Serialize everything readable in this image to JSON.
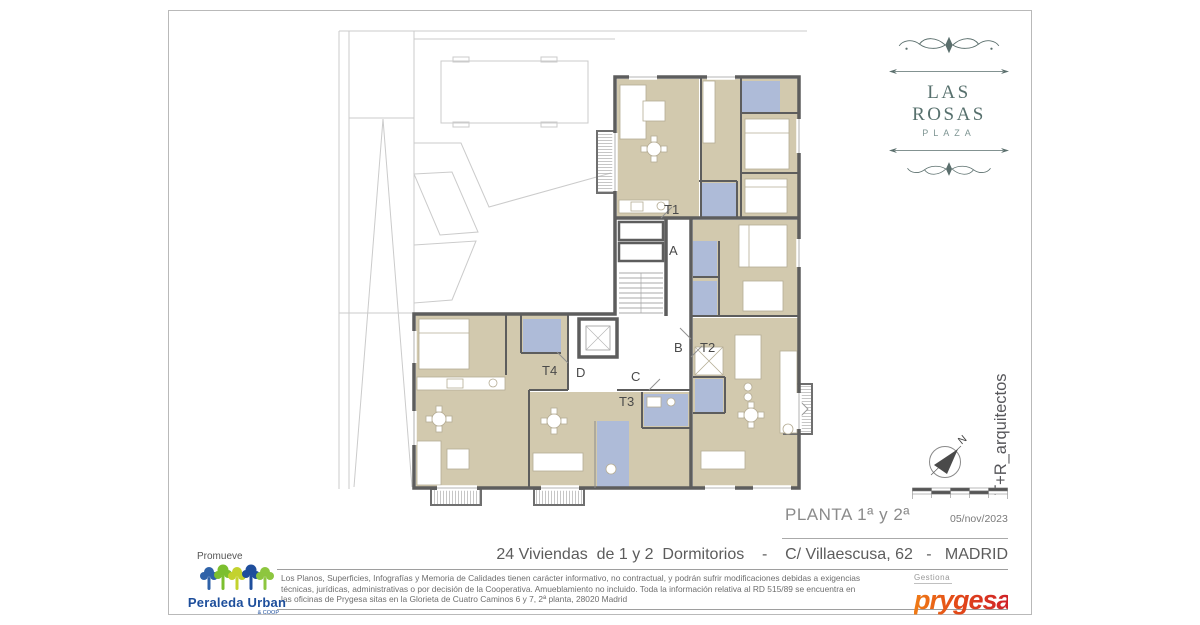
{
  "brand": {
    "name": "LAS ROSAS",
    "tagline": "PLAZA"
  },
  "architect_signature": "T+R_arquitectos",
  "compass": {
    "north_label": "N"
  },
  "plan": {
    "labels": [
      {
        "text": "T1"
      },
      {
        "text": "A"
      },
      {
        "text": "B"
      },
      {
        "text": "T2"
      },
      {
        "text": "C"
      },
      {
        "text": "T3"
      },
      {
        "text": "T4"
      },
      {
        "text": "D"
      }
    ]
  },
  "title_block": {
    "plan_title": "PLANTA 1ª y 2ª",
    "date": "05/nov/2023",
    "project_description": "24 Viviendas  de 1 y 2  Dormitorios    -    C/ Villaescusa, 62   -   MADRID",
    "promoter": {
      "label": "Promueve",
      "name": "Peraleda Urban",
      "suffix": "& COOP"
    },
    "manager": {
      "label": "Gestiona",
      "name": "prygesa"
    },
    "disclaimer_lines": [
      "Los Planos, Superficies, Infografías y Memoria de Calidades tienen carácter informativo, no contractual, y podrán sufrir modificaciones debidas a exigencias",
      "técnicas, jurídicas, administrativas o por decisión de la Cooperativa. Amueblamiento no incluido. Toda la información relativa al RD 515/89 se encuentra en",
      "las oficinas de Prygesa sitas en la Glorieta de Cuatro Caminos 6 y 7, 2ª planta, 28020 Madrid"
    ]
  },
  "colors": {
    "room_fill": "#d2c9ae",
    "bath_fill": "#aebbd8",
    "wall": "#5d5d5d",
    "site_line": "#cbcbcb",
    "brand_green": "#5a6e6c",
    "prygesa_orange": "#e8511d",
    "prygesa_red": "#cf2127",
    "peraleda_blue": "#1d4e9b",
    "peraleda_green": "#7cbf2f"
  }
}
